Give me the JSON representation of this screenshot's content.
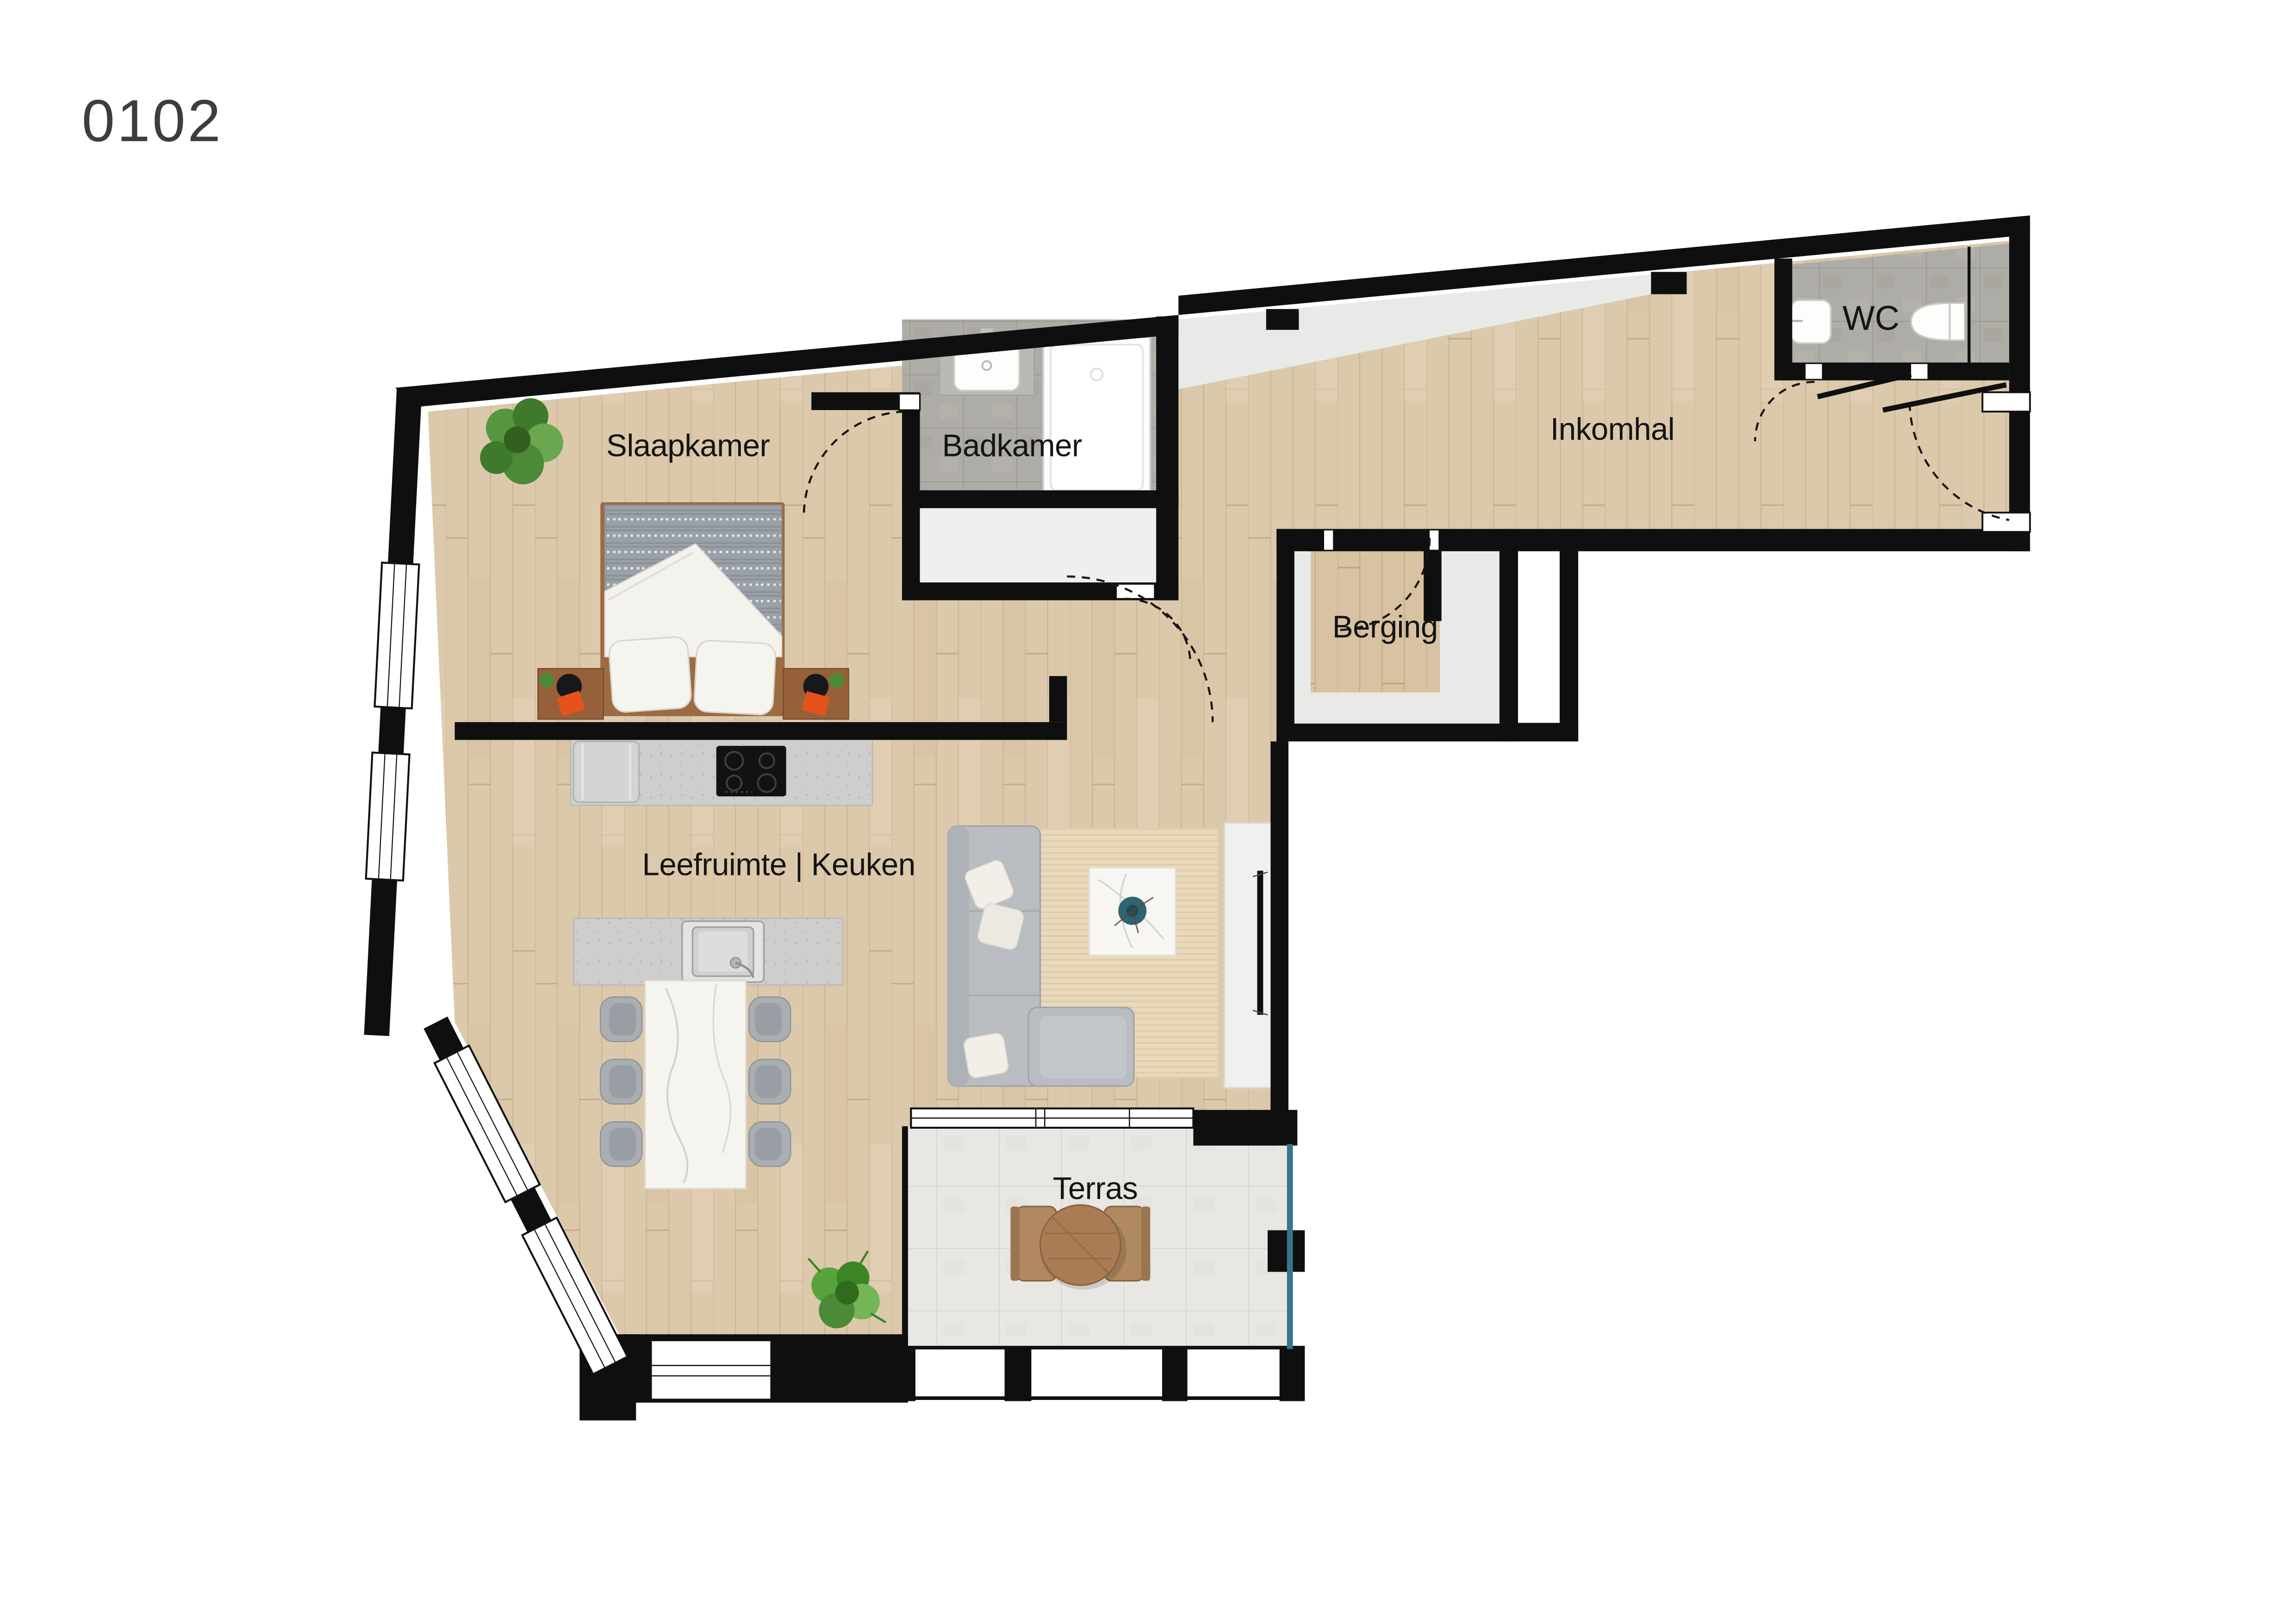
{
  "unit": {
    "number": "0102"
  },
  "rooms": [
    {
      "id": "slaapkamer",
      "label": "Slaapkamer"
    },
    {
      "id": "badkamer",
      "label": "Badkamer"
    },
    {
      "id": "inkomhal",
      "label": "Inkomhal"
    },
    {
      "id": "wc",
      "label": "WC"
    },
    {
      "id": "berging",
      "label": "Berging"
    },
    {
      "id": "leefruimte",
      "label": "Leefruimte | Keuken"
    },
    {
      "id": "terras",
      "label": "Terras"
    }
  ],
  "colors": {
    "wall": "#0f0f0f",
    "wood_floor": "#dcc9ac",
    "wood_plank_line": "#c8b290",
    "berging_wood": "#d8c2a2",
    "bath_tile": "#aeaca6",
    "bath_tile_line": "#9c9992",
    "terrace_tile": "#e8e7e4",
    "terrace_tile_line": "#d8d6d1",
    "gray_zone": "#e9e9e8",
    "counter": "#cfcecc",
    "sofa": "#b9bcc1",
    "rug": "#eadabd",
    "bed_blanket": "#9aa1a8",
    "marble": "#f6f4ef",
    "vase_teal": "#2f6573",
    "glass_teal": "#35778a",
    "accent_orange": "#e6521c",
    "plant_green": "#4c8a38",
    "terrace_wood": "#a97c54",
    "label_text": "#141414"
  },
  "furniture": [
    "double-bed",
    "nightstands",
    "bedroom-plant",
    "bathroom-sink",
    "shower-tray",
    "wc-sink",
    "toilet",
    "kitchen-counter",
    "fridge",
    "cooktop",
    "island-sink",
    "dining-table",
    "dining-chairs",
    "sofa",
    "rug",
    "coffee-table",
    "vase",
    "tv-cabinet",
    "tv",
    "living-plant",
    "terrace-table",
    "terrace-chairs"
  ]
}
